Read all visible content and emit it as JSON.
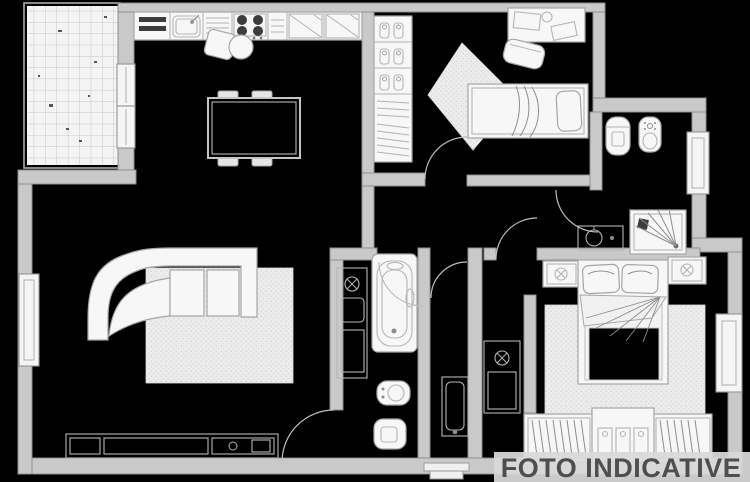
{
  "image": {
    "width": 750,
    "height": 482,
    "background": "#000000"
  },
  "watermark": {
    "text": "FOTO INDICATIVE",
    "band_color": "#d9d9d9",
    "text_color": "#4e4e4e"
  },
  "palette": {
    "wall_fill": "#c9c9c9",
    "wall_stroke": "#8e8e8e",
    "furniture_fill": "#f7f7f7",
    "furniture_stroke": "#a5a5a5",
    "rug_fill": "#ececec",
    "rug_dot": "#cfcfcf",
    "tile_fill": "#f4f4f4",
    "tile_line": "#c6c6c6"
  }
}
